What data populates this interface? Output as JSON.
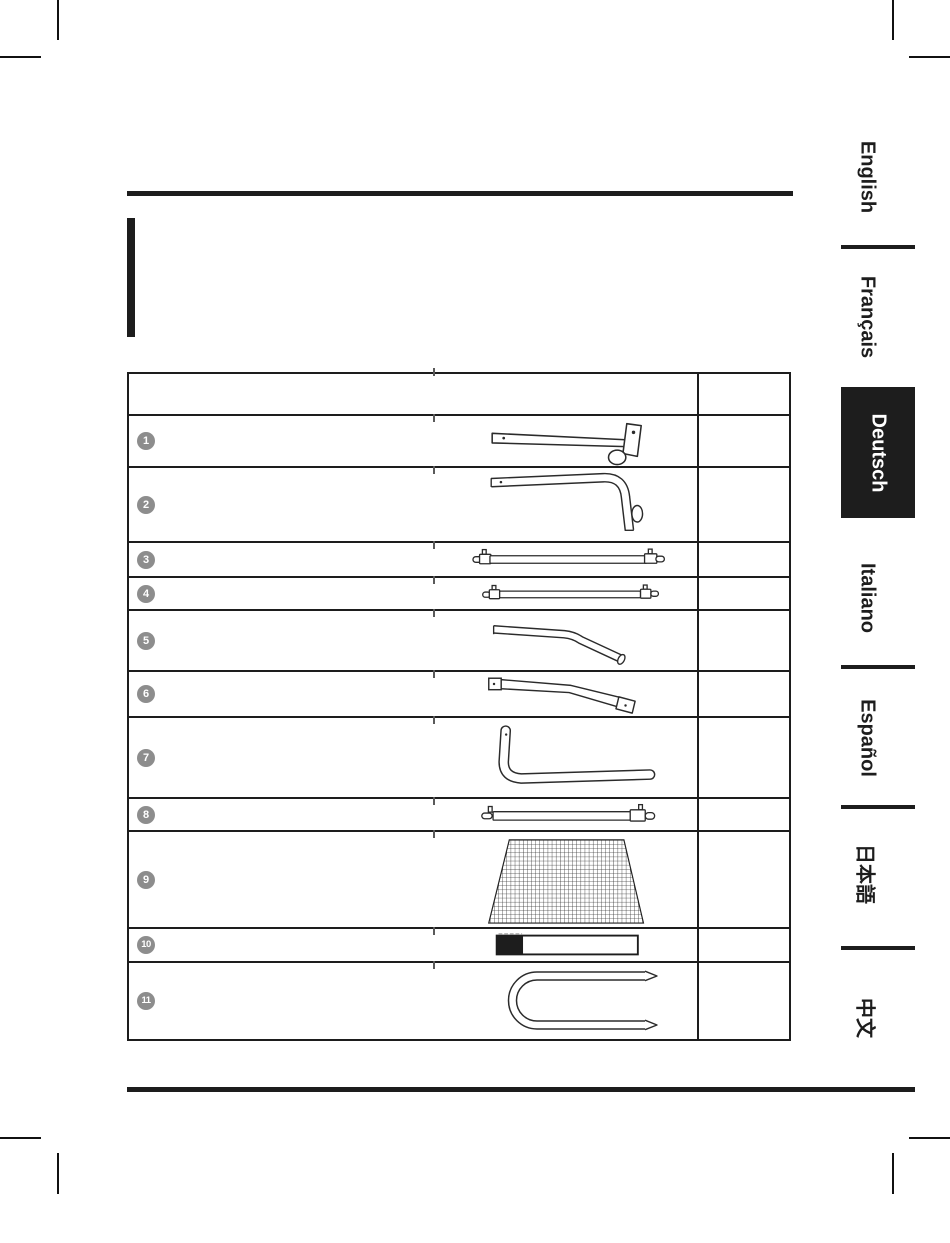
{
  "document": {
    "type": "assembly-manual-parts-list-page",
    "active_language": "Deutsch"
  },
  "language_tabs": {
    "items": [
      {
        "label": "English",
        "active": false
      },
      {
        "label": "Français",
        "active": false
      },
      {
        "label": "Deutsch",
        "active": true
      },
      {
        "label": "Italiano",
        "active": false
      },
      {
        "label": "Español",
        "active": false
      },
      {
        "label": "日本語",
        "active": false
      },
      {
        "label": "中文",
        "active": false
      }
    ]
  },
  "parts_table": {
    "header": {
      "left_cell": "",
      "right_cell": ""
    },
    "rows": [
      {
        "number": "1",
        "part_icon": "bracket-arm-tube-icon"
      },
      {
        "number": "2",
        "part_icon": "bent-elbow-tube-icon"
      },
      {
        "number": "3",
        "part_icon": "long-pole-with-pins-icon"
      },
      {
        "number": "4",
        "part_icon": "short-pole-with-pins-icon"
      },
      {
        "number": "5",
        "part_icon": "angled-tube-icon"
      },
      {
        "number": "6",
        "part_icon": "linkage-tube-with-fittings-icon"
      },
      {
        "number": "7",
        "part_icon": "l-shaped-tube-icon"
      },
      {
        "number": "8",
        "part_icon": "crossbar-tube-with-caps-icon"
      },
      {
        "number": "9",
        "part_icon": "net-panel-icon"
      },
      {
        "number": "10",
        "part_icon": "strap-icon"
      },
      {
        "number": "11",
        "part_icon": "u-shaped-tube-icon"
      }
    ]
  },
  "colors": {
    "rule": "#1d1d1d",
    "number_badge": "#8d8d8d",
    "active_tab_bg": "#1d1d1d",
    "active_tab_text": "#ffffff",
    "tab_text": "#1d1d1d"
  }
}
